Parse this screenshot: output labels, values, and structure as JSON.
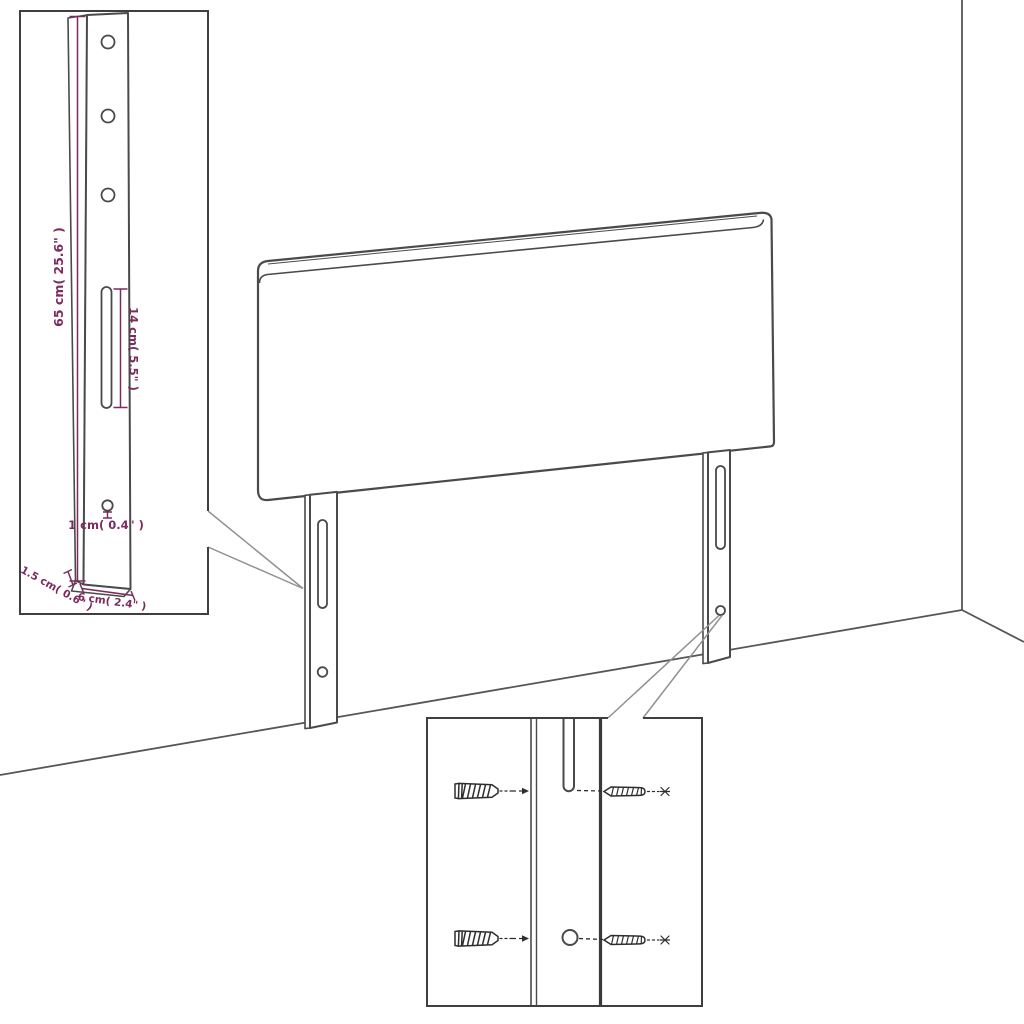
{
  "diagram": {
    "subject": "headboard-with-mounting-legs-dimension-diagram",
    "labels": {
      "leg_height": "65 cm( 25.6\" )",
      "slot_length": "14 cm( 5.5\" )",
      "hole_diameter": "1 cm( 0.4\" )",
      "leg_depth": "1.5 cm( 0.6\" )",
      "leg_width": "6 cm( 2.4\" )"
    },
    "colors": {
      "outline": "#4a4a4a",
      "hardware": "#2e2e2e",
      "dimension": "#7c2b5e",
      "callout": "#919191",
      "background": "#ffffff"
    }
  }
}
